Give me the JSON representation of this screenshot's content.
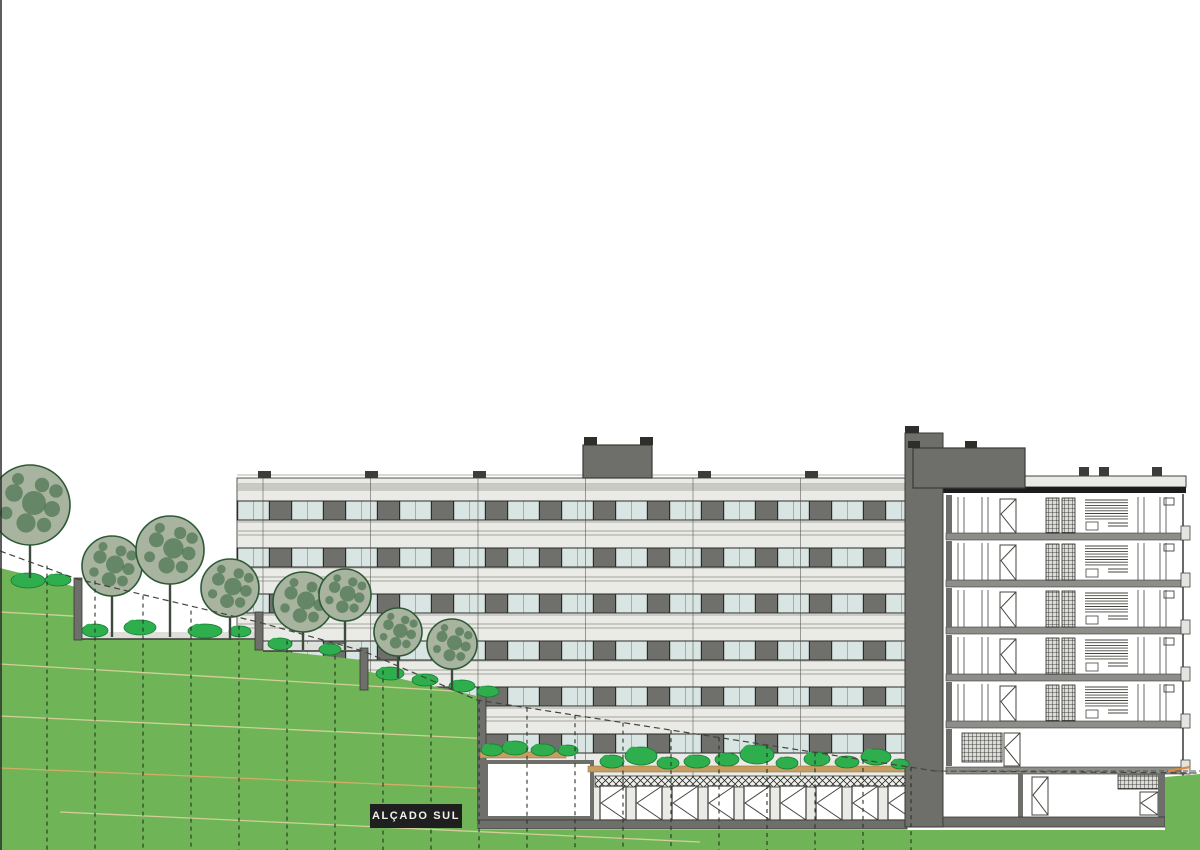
{
  "label": {
    "text": "ALÇADO SUL"
  },
  "scene": {
    "colors": {
      "grass": "#6fb457",
      "bush": "#2fae4e",
      "bush_edge": "#157a33",
      "canopy": "#a9b4a0",
      "canopy_edge": "#2d5a36",
      "canopy_speckle": "#2f6339",
      "trunk": "#3e4a3c",
      "facade_light": "#eaeae6",
      "facade_line": "#96968f",
      "rail_line": "#a6a6a0",
      "glass": "#d9e5e3",
      "panel_dark": "#6f6f6b",
      "frame_dark": "#2b2b27",
      "wall_gray": "#6e6e6a",
      "wall_edge": "#3a3a35",
      "roof_black": "#1c1c1c",
      "slab_gray": "#8d8d89",
      "planter_tan": "#c79e62",
      "planter_edge": "#8a6b3f",
      "contour_tan": "#d9d19c",
      "contour_orange": "#dbae67",
      "grade_dash": "#44443f",
      "grid_dash": "#223522",
      "section_line": "#44443f",
      "tick_orange": "#d98b3f",
      "label_bg": "#1f1f1f",
      "label_fg": "#f2f2ef"
    },
    "elevation": {
      "x": 237,
      "right": 905,
      "top": 478,
      "base_top": 820,
      "base_h": 9,
      "window_band_tops": [
        501,
        548,
        594,
        641,
        687,
        734
      ],
      "window_band_h": 19,
      "parapet_lines": [
        486,
        490
      ],
      "joints_x": [
        263,
        370.5,
        478,
        585.5,
        693,
        800.5
      ],
      "vents_x": [
        258,
        365,
        473,
        586,
        698,
        805
      ],
      "roof_box": {
        "x": 583,
        "y": 445,
        "w": 69,
        "h": 33,
        "caps_x": [
          584,
          640
        ]
      },
      "left_wall": {
        "x": 477,
        "y": 688,
        "w": 9,
        "h": 132
      },
      "white_opening": {
        "x": 486,
        "y": 762,
        "w": 106,
        "h": 56
      },
      "planters": [
        [
          480,
          752,
          86,
          6
        ],
        [
          588,
          766,
          320,
          6
        ]
      ],
      "hatch_band": {
        "x": 595,
        "y": 776,
        "w": 310,
        "h": 11
      },
      "doors": {
        "start_x": 600,
        "step": 36,
        "count": 9,
        "w": 26,
        "y": 786,
        "h": 34
      }
    },
    "section": {
      "cut_wall": {
        "x": 905,
        "y": 433,
        "w": 38,
        "h": 394,
        "cap": [
          905,
          426,
          14,
          7
        ]
      },
      "roof_box": {
        "x": 913,
        "y": 448,
        "w": 112,
        "h": 40,
        "caps_x": [
          908,
          965
        ]
      },
      "parapet": {
        "x": 1025,
        "y": 476,
        "w": 161,
        "h": 11
      },
      "parapet_vents_x": [
        1079,
        1099,
        1152
      ],
      "roof_band": {
        "x": 943,
        "y": 487,
        "w": 243,
        "h": 6
      },
      "left": 946,
      "right": 1183,
      "slabs_y": [
        533,
        580,
        627,
        674,
        721,
        767
      ],
      "floors": [
        [
          495,
          533
        ],
        [
          541,
          580
        ],
        [
          588,
          627
        ],
        [
          635,
          674
        ],
        [
          682,
          721
        ]
      ],
      "mezz": [
        729,
        766
      ],
      "basement": [
        773,
        817
      ],
      "bottom_wall": {
        "x": 943,
        "y": 817,
        "w": 222,
        "h": 10
      },
      "right_base_wall": {
        "x": 1158,
        "y": 773,
        "w": 7,
        "h": 44
      },
      "ground_dash_y": 771
    },
    "terrain": {
      "polygon": "0,568 76,587 80,637 256,640 261,649 362,660 366,671 477,696 477,830 1165,830 1165,777 1200,774 1200,850 0,850",
      "walls": [
        [
          74,
          578,
          8,
          62
        ],
        [
          255,
          612,
          8,
          38
        ],
        [
          360,
          648,
          8,
          42
        ]
      ],
      "paths": [
        [
          82,
          632,
          173,
          7
        ],
        [
          263,
          644,
          97,
          7
        ]
      ],
      "contours": [
        [
          0,
          612,
          470,
          638
        ],
        [
          0,
          664,
          470,
          692
        ],
        [
          0,
          716,
          900,
          758
        ],
        [
          0,
          768,
          900,
          806
        ],
        [
          60,
          812,
          700,
          842
        ]
      ],
      "contour_colors_idx": [
        0,
        0,
        0,
        1,
        0
      ]
    },
    "vegetation": {
      "trees": [
        [
          30,
          505,
          40,
          578
        ],
        [
          112,
          566,
          30,
          637
        ],
        [
          170,
          550,
          34,
          637
        ],
        [
          230,
          588,
          29,
          640
        ],
        [
          303,
          602,
          30,
          650
        ],
        [
          345,
          595,
          26,
          650
        ],
        [
          398,
          632,
          24,
          678
        ],
        [
          452,
          644,
          25,
          690
        ]
      ],
      "speckles": [
        [
          -0.4,
          -0.3,
          0.22
        ],
        [
          0.3,
          -0.5,
          0.18
        ],
        [
          0.55,
          0.1,
          0.2
        ],
        [
          -0.1,
          0.45,
          0.24
        ],
        [
          -0.6,
          0.2,
          0.16
        ],
        [
          0.1,
          -0.05,
          0.3
        ],
        [
          0.35,
          0.5,
          0.18
        ],
        [
          -0.3,
          -0.65,
          0.15
        ],
        [
          0.65,
          -0.35,
          0.17
        ]
      ],
      "bushes": [
        [
          28,
          588,
          34,
          15
        ],
        [
          58,
          586,
          26,
          12
        ],
        [
          95,
          637,
          26,
          13
        ],
        [
          140,
          635,
          32,
          15
        ],
        [
          205,
          638,
          34,
          14
        ],
        [
          240,
          637,
          22,
          11
        ],
        [
          280,
          650,
          24,
          12
        ],
        [
          330,
          655,
          22,
          11
        ],
        [
          390,
          680,
          28,
          13
        ],
        [
          425,
          686,
          26,
          12
        ],
        [
          462,
          692,
          26,
          12
        ],
        [
          488,
          697,
          22,
          11
        ],
        [
          492,
          756,
          22,
          12
        ],
        [
          515,
          755,
          26,
          14
        ],
        [
          543,
          756,
          24,
          12
        ],
        [
          568,
          756,
          20,
          11
        ],
        [
          612,
          768,
          24,
          13
        ],
        [
          641,
          765,
          32,
          18
        ],
        [
          668,
          769,
          22,
          12
        ],
        [
          697,
          768,
          26,
          13
        ],
        [
          727,
          766,
          24,
          13
        ],
        [
          757,
          764,
          34,
          19
        ],
        [
          787,
          769,
          22,
          12
        ],
        [
          817,
          766,
          26,
          14
        ],
        [
          847,
          768,
          24,
          12
        ],
        [
          876,
          765,
          30,
          16
        ],
        [
          900,
          769,
          18,
          10
        ]
      ]
    },
    "annotations": {
      "grade_line_points": "0,551 77,579 258,622 363,651 477,700 935,771 1200,773",
      "grid_first_x": 47,
      "grid_step": 48,
      "grid_count": 19,
      "ground_dash": [
        935,
        771,
        1200,
        771
      ],
      "orange_tick": [
        1168,
        771,
        1190,
        767
      ],
      "sheet_edge_x": 1
    }
  }
}
